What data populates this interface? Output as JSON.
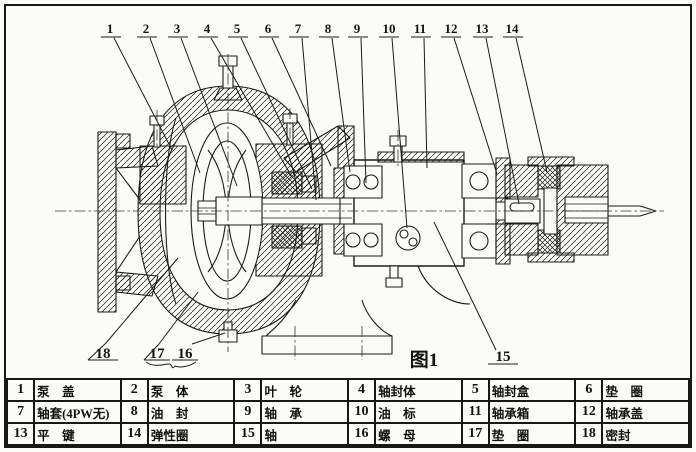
{
  "figure": {
    "caption": "图1",
    "type": "pump-cross-section-diagram"
  },
  "callouts": {
    "top": [
      "1",
      "2",
      "3",
      "4",
      "5",
      "6",
      "7",
      "8",
      "9",
      "10",
      "11",
      "12",
      "13",
      "14"
    ],
    "bottom": [
      "18",
      "17",
      "16",
      "15"
    ]
  },
  "parts": [
    {
      "no": "1",
      "name": "泵　盖"
    },
    {
      "no": "2",
      "name": "泵　体"
    },
    {
      "no": "3",
      "name": "叶　轮"
    },
    {
      "no": "4",
      "name": "轴封体"
    },
    {
      "no": "5",
      "name": "轴封盒"
    },
    {
      "no": "6",
      "name": "垫　圈"
    },
    {
      "no": "7",
      "name": "轴套(4PW无)"
    },
    {
      "no": "8",
      "name": "油　封"
    },
    {
      "no": "9",
      "name": "轴　承"
    },
    {
      "no": "10",
      "name": "油　标"
    },
    {
      "no": "11",
      "name": "轴承箱"
    },
    {
      "no": "12",
      "name": "轴承盖"
    },
    {
      "no": "13",
      "name": "平　键"
    },
    {
      "no": "14",
      "name": "弹性圈"
    },
    {
      "no": "15",
      "name": "轴"
    },
    {
      "no": "16",
      "name": "螺　母"
    },
    {
      "no": "17",
      "name": "垫　圈"
    },
    {
      "no": "18",
      "name": "密封"
    }
  ],
  "colors": {
    "ink": "#1b1b1b",
    "paper": "#fbfbf7"
  }
}
